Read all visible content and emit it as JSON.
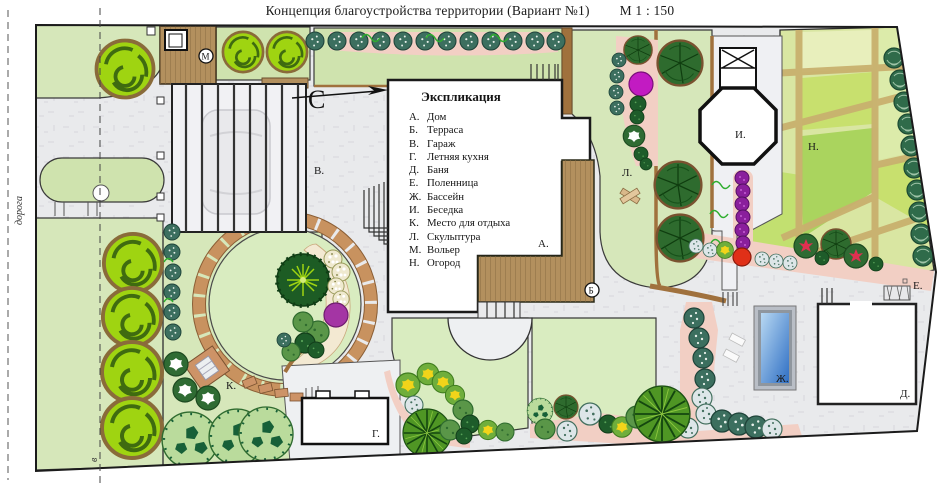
{
  "title": {
    "main": "Концепция  благоустройства  территории   (Вариант №1)",
    "scale": "М 1 : 150"
  },
  "legend": {
    "title": "Экспликация",
    "items": [
      {
        "key": "А.",
        "label": "Дом"
      },
      {
        "key": "Б.",
        "label": "Терраса"
      },
      {
        "key": "В.",
        "label": "Гараж"
      },
      {
        "key": "Г.",
        "label": "Летняя кухня"
      },
      {
        "key": "Д.",
        "label": "Баня"
      },
      {
        "key": "Е.",
        "label": "Поленница"
      },
      {
        "key": "Ж.",
        "label": "Бассейн"
      },
      {
        "key": "И.",
        "label": "Беседка"
      },
      {
        "key": "К.",
        "label": "Место для отдыха"
      },
      {
        "key": "Л.",
        "label": "Скульптура"
      },
      {
        "key": "М.",
        "label": "Вольер"
      },
      {
        "key": "Н.",
        "label": "Огород"
      }
    ]
  },
  "plan_labels": {
    "house": "А.",
    "terrace": "Б",
    "garage": "В.",
    "summer_kitchen": "Г.",
    "bathhouse": "Д.",
    "woodpile": "Е.",
    "pool": "Ж.",
    "gazebo": "И.",
    "rest_area": "К.",
    "sculpture": "Л.",
    "aviary": "М",
    "vegetable_garden": "Н."
  },
  "annotations": {
    "road": "дорога",
    "section_mark": "в",
    "north": "С"
  },
  "colors": {
    "lawn": "#d6e7ba",
    "paving": "#e9eaec",
    "deck": "#b3905e",
    "paver": "#c8925f",
    "pool_water": "#4a8fd8",
    "bright_tree": "#9fd411",
    "dark_tree": "#2e6b2e",
    "bed_pink": "#f2cfc4",
    "garden_bed": "#d9e6a2",
    "path_tan": "#c9b06e",
    "purple": "#8a1f9c",
    "magenta": "#c21bc2",
    "red": "#e03018"
  }
}
